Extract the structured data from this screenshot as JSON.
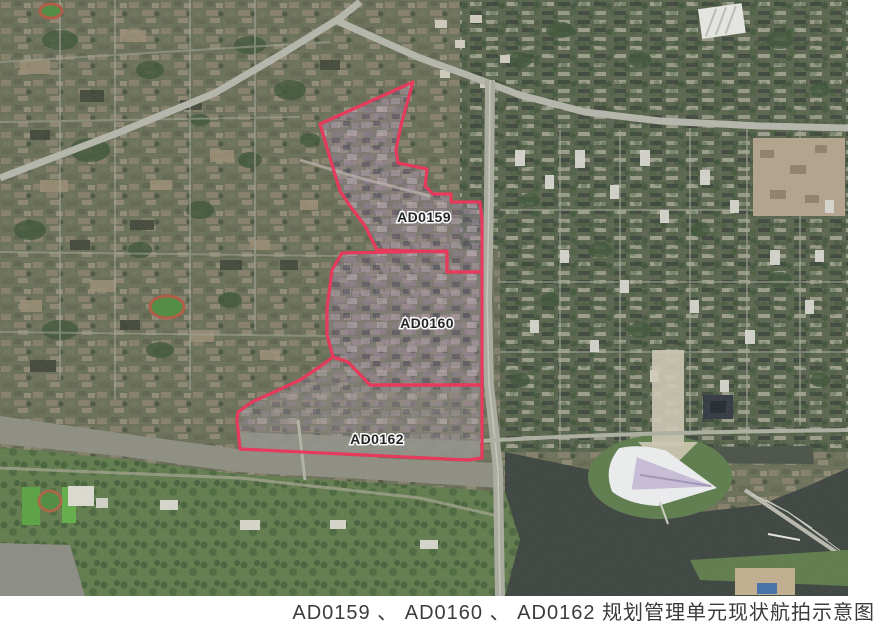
{
  "figure": {
    "caption": "AD0159 、 AD0160 、 AD0162 规划管理单元现状航拍示意图",
    "caption_color": "#3b3b3b"
  },
  "map": {
    "kind": "satellite-aerial-photo",
    "unit_labels": [
      {
        "id": "AD0159",
        "label": "AD0159"
      },
      {
        "id": "AD0160",
        "label": "AD0160"
      },
      {
        "id": "AD0162",
        "label": "AD0162"
      }
    ],
    "boundary_color": "#e93054",
    "zone_tint_color": "#a08aa2",
    "label_text_color": "#181818",
    "label_halo_color": "#ffffff",
    "river_color": "#39413c",
    "creek_color": "#8c8c80",
    "vegetation_color": "#5e7a49",
    "urban_base_color": "#676d54"
  }
}
